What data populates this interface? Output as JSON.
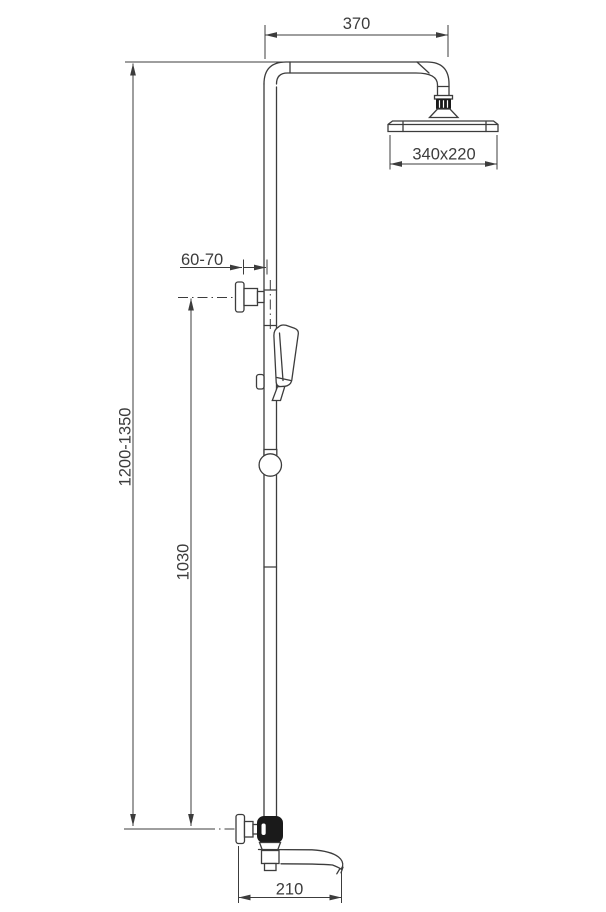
{
  "diagram": {
    "kind": "technical-drawing",
    "units": "mm",
    "labels": {
      "arm_reach": "370",
      "head_size": "340x220",
      "wall_distance": "60-70",
      "total_height": "1200-1350",
      "slide_bar_height": "1030",
      "spout_reach": "210"
    },
    "colors": {
      "line": "#3c3c3c",
      "solid_fill": "#1a1a1a",
      "background": "#ffffff"
    }
  }
}
